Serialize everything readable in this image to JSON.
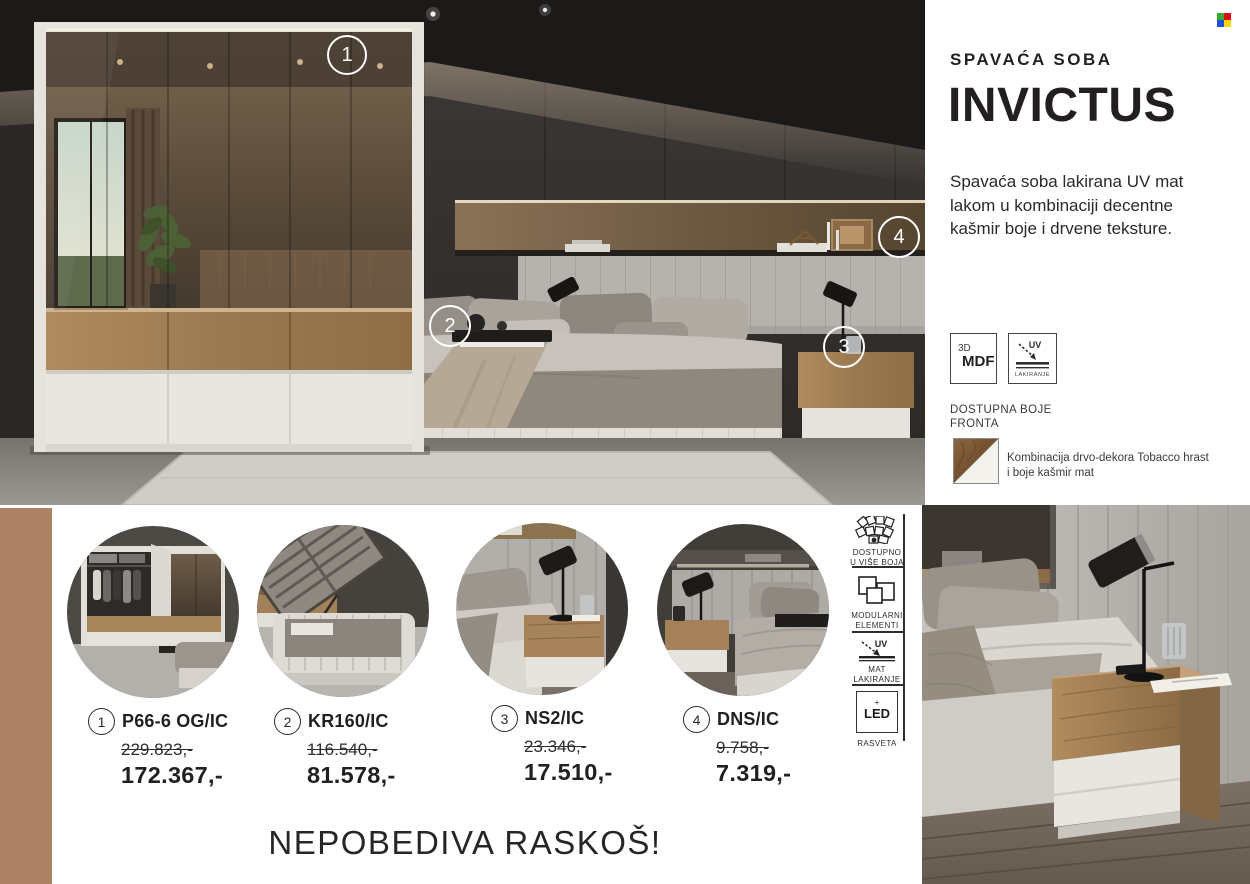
{
  "brand": {
    "logo_icon": "four-color-squares",
    "logo_colors": {
      "top_left": "#3aaa35",
      "top_right": "#e30613",
      "bottom_left": "#1d4fd7",
      "bottom_right": "#ffd500"
    }
  },
  "header": {
    "category": "SPAVAĆA SOBA",
    "title": "INVICTUS",
    "description": "Spavaća soba lakirana UV mat lakom u kombinaciji decentne kašmir boje i drvene teksture."
  },
  "materials": {
    "mdf_top": "3D",
    "mdf_label": "MDF",
    "uv_label": "UV",
    "uv_sub": "LAKIRANJE"
  },
  "fronts": {
    "heading_line1": "DOSTUPNA BOJE",
    "heading_line2": "FRONTA",
    "caption": "Kombinacija drvo-dekora Tobacco hrast i boje kašmir mat"
  },
  "features": {
    "item1": {
      "icon": "color-fan-icon",
      "line1": "DOSTUPNO",
      "line2": "U VIŠE BOJA"
    },
    "item2": {
      "icon": "modular-squares-icon",
      "line1": "MODULARNI",
      "line2": "ELEMENTI"
    },
    "item3": {
      "icon": "uv-coating-icon",
      "line1": "MAT",
      "line2": "LAKIRANJE"
    },
    "item4": {
      "icon": "led-box-icon",
      "box_plus": "+",
      "box_label": "LED",
      "label": "RASVETA"
    }
  },
  "photo_markers": {
    "m1": "1",
    "m2": "2",
    "m3": "3",
    "m4": "4"
  },
  "products": [
    {
      "num": "1",
      "code": "P66-6 OG/IC",
      "old_price": "229.823,-",
      "price": "172.367,-"
    },
    {
      "num": "2",
      "code": "KR160/IC",
      "old_price": "116.540,-",
      "price": "81.578,-"
    },
    {
      "num": "3",
      "code": "NS2/IC",
      "old_price": "23.346,-",
      "price": "17.510,-"
    },
    {
      "num": "4",
      "code": "DNS/IC",
      "old_price": "9.758,-",
      "price": "7.319,-"
    }
  ],
  "tagline": "NEPOBEDIVA RASKOŠ!",
  "colors": {
    "side_stripe": "#ac8465",
    "uv_badge_color": "#2e2e2e"
  }
}
